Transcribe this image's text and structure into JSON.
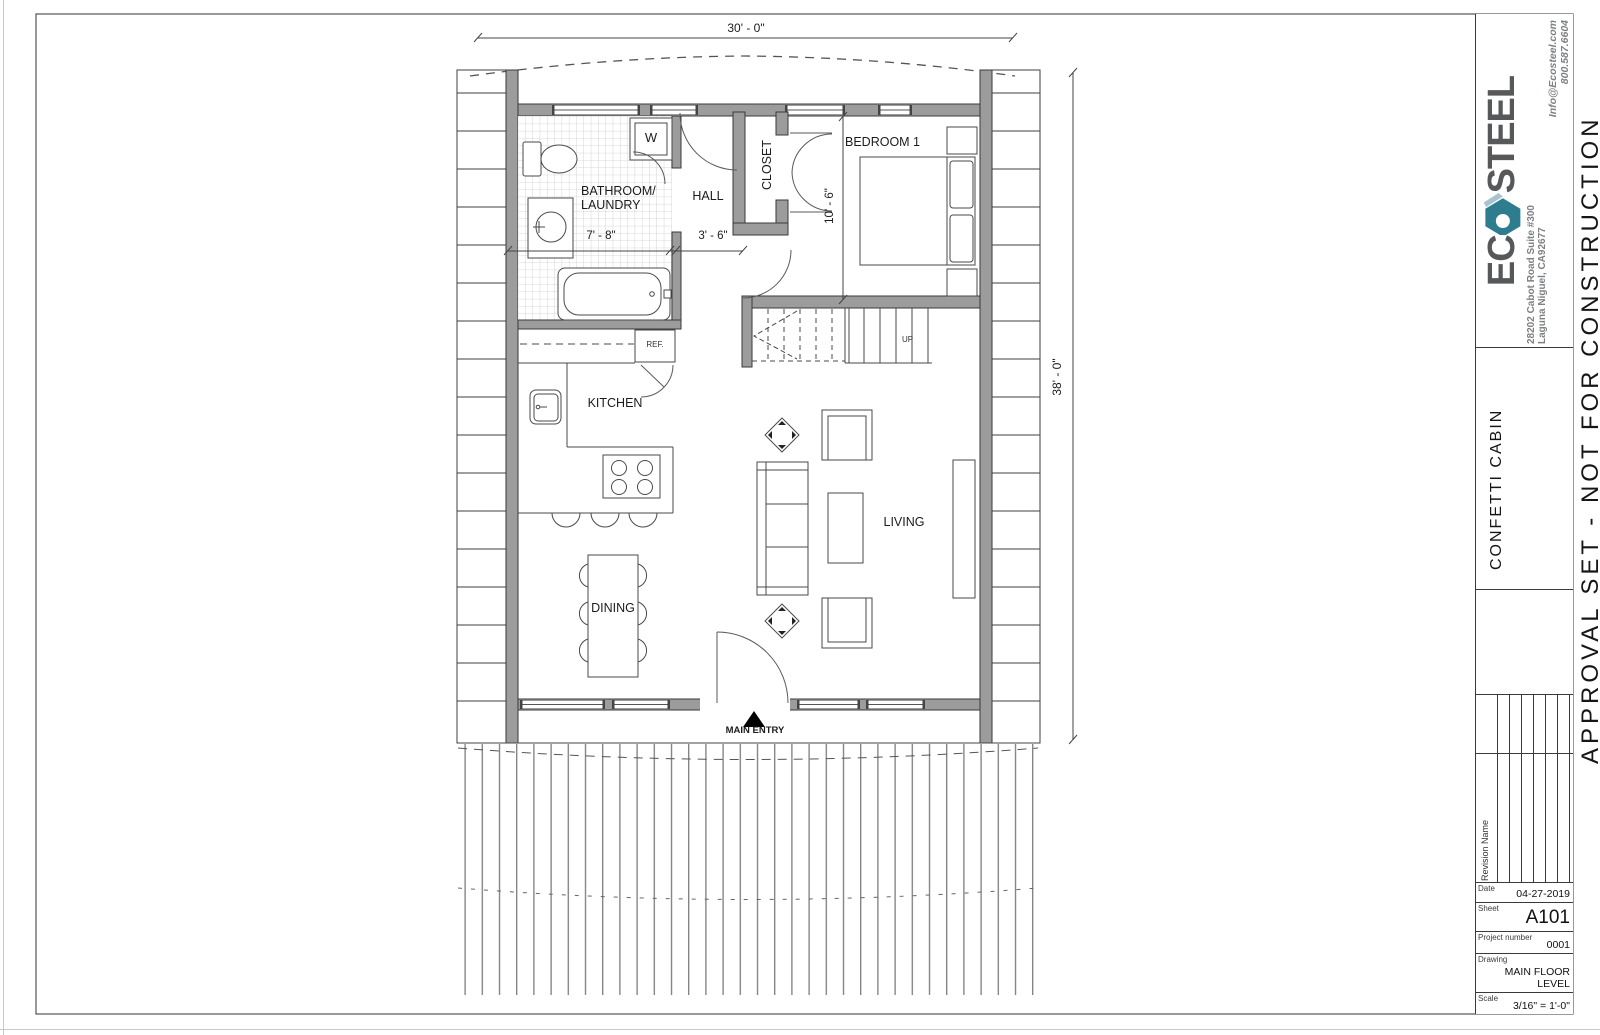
{
  "title_block": {
    "logo": {
      "prefix": "EC",
      "suffix": "STEEL"
    },
    "address_line1": "28202 Cabot Road Suite #300",
    "address_line2": "Laguna Niguel, CA92677",
    "contact_line1": "Info@Ecosteel.com",
    "contact_line2": "800.587.6604",
    "project_name": "CONFETTI CABIN",
    "revision_header": "Revision Name",
    "fields": {
      "date_label": "Date",
      "date_value": "04-27-2019",
      "sheet_label": "Sheet",
      "sheet_value": "A101",
      "project_label": "Project number",
      "project_value": "0001",
      "drawing_label": "Drawing",
      "drawing_value": "MAIN FLOOR LEVEL",
      "scale_label": "Scale",
      "scale_value": "3/16\" = 1'-0\""
    },
    "stamp": "APPROVAL SET - NOT FOR CONSTRUCTION",
    "colors": {
      "logo_gray": "#57585a",
      "logo_teal": "#2e7d8f",
      "logo_teal_light": "#a7c3cb",
      "text_gray": "#7e8083"
    }
  },
  "plan": {
    "labels": {
      "bathroom_line1": "BATHROOM/",
      "bathroom_line2": "LAUNDRY",
      "hall": "HALL",
      "closet": "CLOSET",
      "bedroom": "BEDROOM 1",
      "kitchen": "KITCHEN",
      "dining": "DINING",
      "living": "LIVING",
      "ref": "REF.",
      "washer": "W",
      "up": "UP",
      "main_entry": "MAIN ENTRY"
    },
    "dimensions": {
      "overall_width": "30' - 0\"",
      "overall_height": "38' - 0\"",
      "bathroom_width": "7' - 8\"",
      "hall_width": "3' - 6\"",
      "bedroom_height": "10' - 6\""
    }
  }
}
